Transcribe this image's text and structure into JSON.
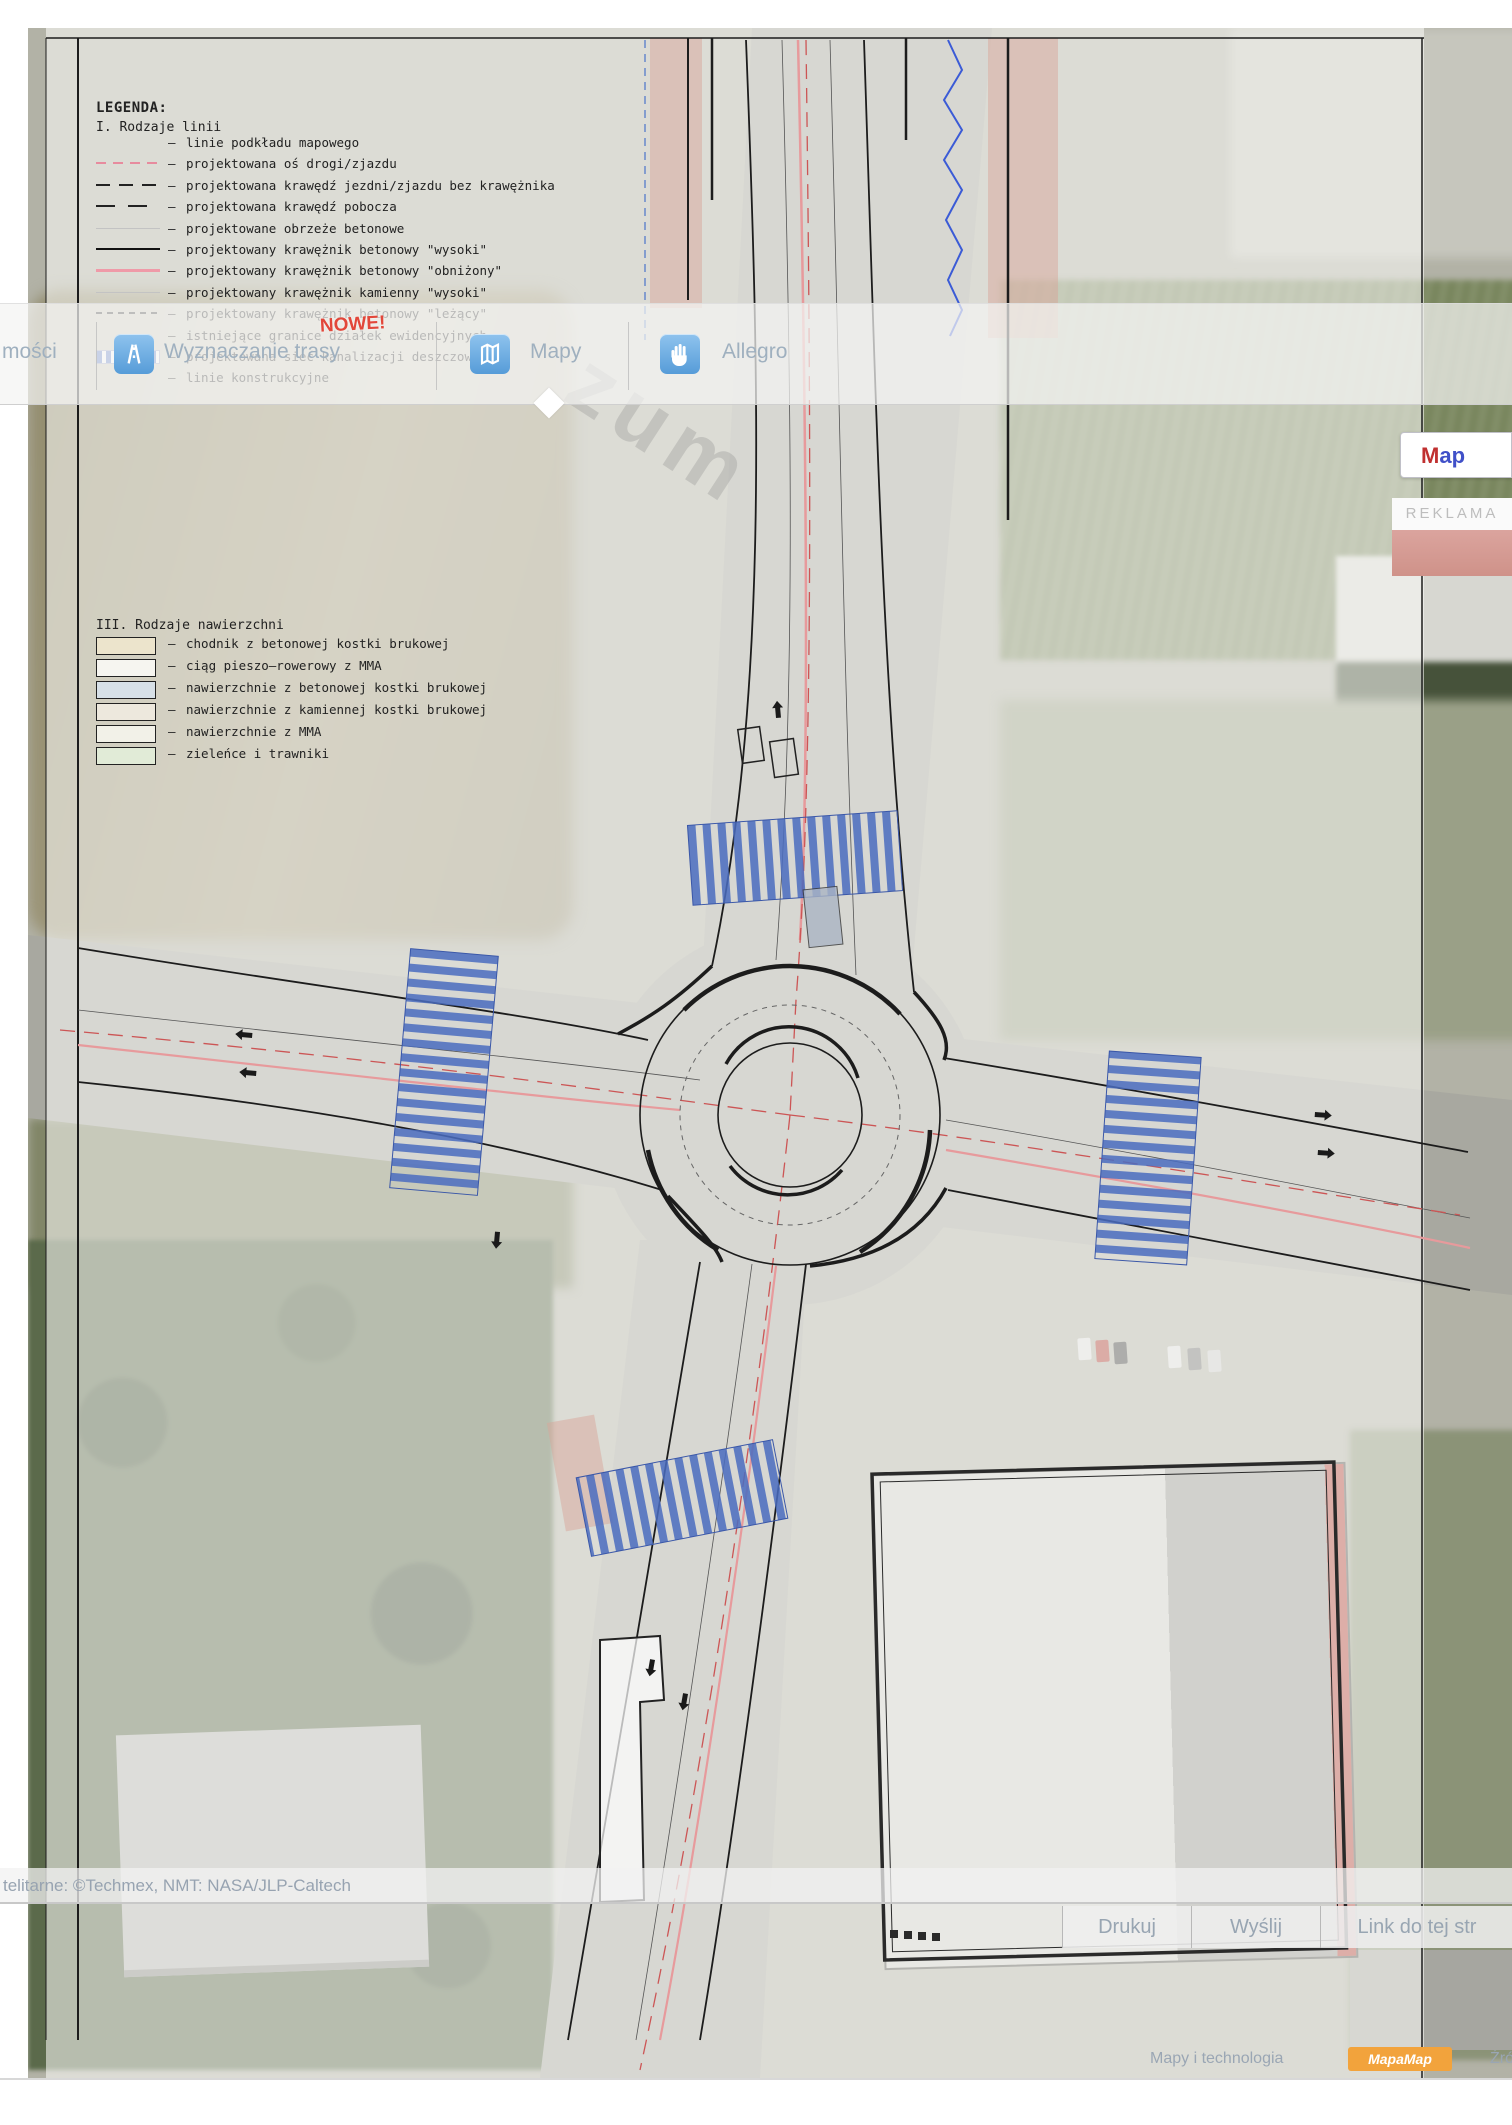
{
  "colors": {
    "toolbar_text": "#9fb0bf",
    "icon_blue": "#569cd8",
    "nowe_red": "#e2473a",
    "crosswalk_blue": "#4a6cc0",
    "plan_pink": "#e79a9c",
    "axis_red": "#cc5555",
    "mapamap_orange": "#f2a33c",
    "reklama_gray": "#bdbdbd"
  },
  "watermark": "zum",
  "toolbar": {
    "left_cut_label": "mości",
    "items": [
      {
        "label": "Wyznaczanie trasy",
        "badge": "NOWE!",
        "icon": "route-icon"
      },
      {
        "label": "Mapy",
        "icon": "map-icon",
        "active": true
      },
      {
        "label": "Allegro",
        "icon": "hand-icon"
      }
    ]
  },
  "right_panel": {
    "map_button": "Map",
    "reklama": "REKLAMA"
  },
  "attribution": "telitarne: ©Techmex, NMT: NASA/JLP-Caltech",
  "actions": [
    {
      "label": "Drukuj"
    },
    {
      "label": "Wyślij"
    },
    {
      "label": "Link do tej str"
    }
  ],
  "bottom_bar": {
    "tech_label": "Mapy i technologia",
    "logo": "MapaMap",
    "source_cut": "Źró"
  },
  "legend1": {
    "title": "LEGENDA:",
    "subtitle": "I. Rodzaje linii",
    "marker": "–",
    "items": [
      {
        "label": "linie podkładu mapowego",
        "swatch": "none"
      },
      {
        "label": "projektowana oś drogi/zjazdu",
        "swatch": "pink-dash"
      },
      {
        "label": "projektowana krawędź jezdni/zjazdu bez krawężnika",
        "swatch": "black-longdash"
      },
      {
        "label": "projektowana krawędź pobocza",
        "swatch": "black-dash"
      },
      {
        "label": "projektowane obrzeże betonowe",
        "swatch": "gray-faint"
      },
      {
        "label": "projektowany krawężnik betonowy \"wysoki\"",
        "swatch": "black-solid"
      },
      {
        "label": "projektowany krawężnik betonowy \"obniżony\"",
        "swatch": "pink-solid"
      },
      {
        "label": "projektowany krawężnik kamienny \"wysoki\"",
        "swatch": "gray-faint"
      },
      {
        "label": "projektowany krawężnik betonowy \"leżący\"",
        "swatch": "black-shortdash"
      },
      {
        "label": "istniejące granice działek ewidencyjnych",
        "swatch": "none"
      },
      {
        "label": "projektowana sieć kanalizacji deszczowej",
        "swatch": "blue-hatch"
      },
      {
        "label": "linie konstrukcyjne",
        "swatch": "none"
      }
    ]
  },
  "legend2": {
    "title": "III. Rodzaje nawierzchni",
    "marker": "–",
    "items": [
      {
        "label": "chodnik z betonowej kostki brukowej",
        "fill": "#ece4cc"
      },
      {
        "label": "ciąg pieszo–rowerowy z MMA",
        "fill": "#f6f5f0"
      },
      {
        "label": "nawierzchnie z betonowej kostki brukowej",
        "fill": "#d7e0e7"
      },
      {
        "label": "nawierzchnie z kamiennej kostki brukowej",
        "fill": "#ede8dd"
      },
      {
        "label": "nawierzchnie z MMA",
        "fill": "#f2f1e8"
      },
      {
        "label": "zieleńce i trawniki",
        "fill": "#e1ebd7"
      }
    ]
  },
  "annotations": [
    {
      "t": "220.44",
      "x": 842,
      "y": 106,
      "rot": -8
    },
    {
      "t": "219.00",
      "x": 846,
      "y": 120,
      "rot": -8
    },
    {
      "t": "219.44",
      "x": 628,
      "y": 100,
      "rot": 78
    },
    {
      "t": "219.49",
      "x": 612,
      "y": 118,
      "rot": 78
    },
    {
      "t": "K=200",
      "x": 832,
      "y": 192,
      "rot": -4
    },
    {
      "t": "219.39",
      "x": 838,
      "y": 208,
      "rot": -4
    },
    {
      "t": "K=200",
      "x": 920,
      "y": 228,
      "rot": -4
    },
    {
      "t": "5.1K",
      "x": 936,
      "y": 248
    },
    {
      "t": "220.62",
      "x": 926,
      "y": 266
    },
    {
      "t": "219.50",
      "x": 928,
      "y": 284
    },
    {
      "t": "219.52",
      "x": 798,
      "y": 582,
      "rot": -76
    },
    {
      "t": "220.19",
      "x": 840,
      "y": 604
    },
    {
      "t": "217.50",
      "x": 840,
      "y": 617
    },
    {
      "t": "216.11",
      "x": 694,
      "y": 606
    },
    {
      "t": "215.76",
      "x": 694,
      "y": 619
    },
    {
      "t": "215.56",
      "x": 742,
      "y": 628,
      "rot": -12
    },
    {
      "t": "216.44",
      "x": 812,
      "y": 636,
      "rot": -12
    },
    {
      "t": "217.53",
      "x": 788,
      "y": 652,
      "rot": -70
    },
    {
      "t": "220.19",
      "x": 852,
      "y": 656
    },
    {
      "t": "211.04",
      "x": 852,
      "y": 669
    },
    {
      "t": "ks500/1200",
      "x": 40,
      "y": 952,
      "rot": -3
    },
    {
      "t": "216.04",
      "x": 950,
      "y": 1108,
      "rot": -15
    },
    {
      "t": "214.64",
      "x": 700,
      "y": 1176,
      "rot": -10
    },
    {
      "t": "215.82",
      "x": 1028,
      "y": 1186
    },
    {
      "t": "217.94",
      "x": 1028,
      "y": 1199
    },
    {
      "t": "216.21",
      "x": 1448,
      "y": 1262,
      "color": "#c03a3a"
    },
    {
      "t": "217.62",
      "x": 220,
      "y": 1388
    },
    {
      "t": "216.92",
      "x": 220,
      "y": 1401
    },
    {
      "t": "218.77",
      "x": 505,
      "y": 1686,
      "rot": -75
    },
    {
      "t": "216.27",
      "x": 545,
      "y": 1796,
      "rot": -78
    },
    {
      "t": "214.21",
      "x": 558,
      "y": 1812,
      "rot": -78
    },
    {
      "t": "215.52",
      "x": 84,
      "y": 1818
    },
    {
      "t": "215.92",
      "x": 84,
      "y": 1831
    },
    {
      "t": "215.53",
      "x": 84,
      "y": 2002
    },
    {
      "t": "215.74",
      "x": 84,
      "y": 2015
    },
    {
      "t": "216.38",
      "x": 668,
      "y": 2100
    },
    {
      "t": "213.84",
      "x": 700,
      "y": 2106
    }
  ]
}
